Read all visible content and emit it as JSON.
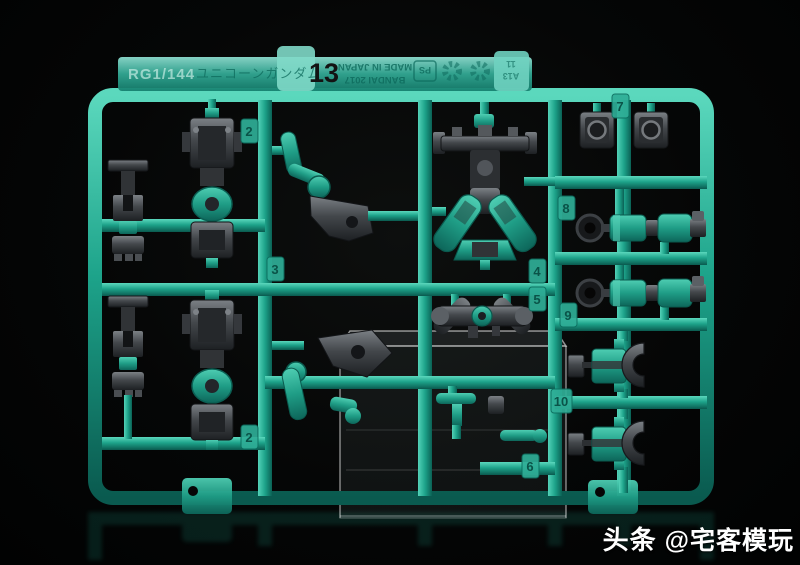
{
  "runner": {
    "label_strip": {
      "scale_text": "RG1/144",
      "kit_name": "ユニコーンガンダム",
      "runner_number": "13",
      "maker_line1": "BANDAI 2017",
      "maker_line2": "MADE IN JAPAN",
      "material_mark": "PS",
      "cavity_tab_line1": "A13",
      "cavity_tab_line2": "11"
    },
    "part_tags": [
      "2",
      "3",
      "2",
      "4",
      "5",
      "7",
      "8",
      "9",
      "10",
      "6"
    ],
    "icons": [
      "resin-recycle-mark",
      "resin-recycle-mark"
    ],
    "colors": {
      "runner_teal": "#1da38a",
      "teal_highlight": "#5bd8bd",
      "teal_shadow": "#0a5a4f",
      "frame_part_gray": "#43474b",
      "number_ink": "#111111",
      "background": "#050606",
      "watermark": "#ffffff"
    }
  },
  "watermark": {
    "brand": "头条",
    "handle": "@宅客模玩"
  }
}
